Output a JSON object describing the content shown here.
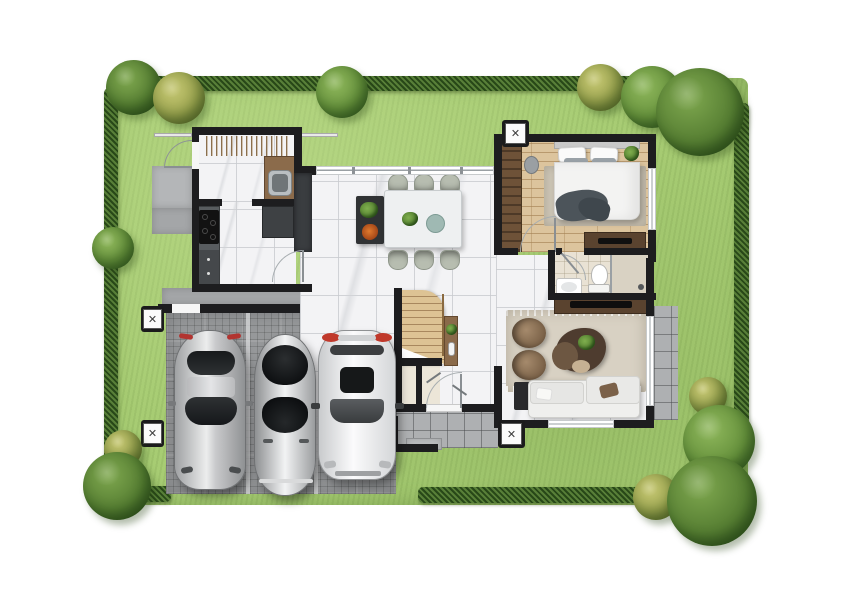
{
  "scene": {
    "kind": "3d-rendered residential floor plan, top-down view",
    "canvas_px": {
      "width": 842,
      "height": 595
    },
    "background": "#ffffff"
  },
  "palette": {
    "lawn": "#a7cc73",
    "hedge": "#41682a",
    "wall": "#1d1d1f",
    "marble_floor": "#f3f3f5",
    "wood_floor": "#dcc49d",
    "bath_floor": "#e9e2d4",
    "paver_drive": "#96989a",
    "tile_porch": "#aeb0b2",
    "dark_cabinet": "#3a3d40",
    "wood_furniture": "#5a432f",
    "sofa": "#efefed",
    "accent_red": "#c0392b"
  },
  "equipment": {
    "ac_unit_count": 4,
    "ac_unit_symbol": "✕"
  },
  "garden": {
    "tree_count": 13,
    "trees": [
      "corner-tree-top-left",
      "yellow-tree-top-left",
      "tree-top-middle",
      "yellow-tree-top-right",
      "tree-top-right",
      "large-tree-top-right-corner",
      "tree-left-middle",
      "yellow-bush-bottom-left",
      "tree-bottom-left-corner",
      "yellow-bush-right",
      "tree-right-side",
      "yellow-tree-bottom-right",
      "large-tree-bottom-right-corner"
    ],
    "hedge_sides": [
      "top",
      "left",
      "right",
      "bottom-left",
      "bottom-right"
    ]
  },
  "rooms": [
    {
      "name": "laundry-room",
      "floor": "marble",
      "features": [
        "hanging-clothes-rack",
        "counter-with-sink",
        "door-to-side-patio"
      ]
    },
    {
      "name": "kitchen",
      "floor": "marble",
      "features": [
        "cooktop-counter",
        "lower-cabinet",
        "refrigerator",
        "pantry-wall"
      ]
    },
    {
      "name": "dining-area",
      "floor": "marble",
      "features": [
        "dining-table",
        "six-chairs",
        "sideboard-with-plants",
        "full-width-window"
      ]
    },
    {
      "name": "hallway",
      "floor": "marble",
      "features": [
        "staircase",
        "console-table",
        "under-stair-closets",
        "front-door"
      ]
    },
    {
      "name": "bedroom",
      "floor": "wood",
      "features": [
        "double-bed",
        "area-rug",
        "wardrobe",
        "vanity-chair",
        "dresser-tv",
        "plant"
      ]
    },
    {
      "name": "bathroom",
      "floor": "beige-tile",
      "features": [
        "toilet",
        "sink-vanity",
        "shower"
      ]
    },
    {
      "name": "living-room",
      "floor": "marble",
      "features": [
        "rug",
        "sofa",
        "two-armchairs",
        "organic-coffee-table",
        "tv-console",
        "side-table"
      ]
    }
  ],
  "outdoor": [
    {
      "name": "driveway",
      "surface": "grey-pavers",
      "parked_cars": 3
    },
    {
      "name": "entry-porch",
      "surface": "grey-tile",
      "features": [
        "steps"
      ]
    },
    {
      "name": "terrace",
      "surface": "grey-tile"
    },
    {
      "name": "side-patio",
      "surface": "concrete"
    },
    {
      "name": "service-walkway",
      "surface": "concrete",
      "features": [
        "gate-opening"
      ]
    }
  ],
  "vehicles": [
    {
      "name": "silver-sports-car",
      "color": "silver",
      "detail": "red-tail-lights"
    },
    {
      "name": "silver-classic-car",
      "color": "silver",
      "detail": "black-curved-glass"
    },
    {
      "name": "white-suv",
      "color": "white",
      "detail": "red-roof-rails"
    }
  ]
}
